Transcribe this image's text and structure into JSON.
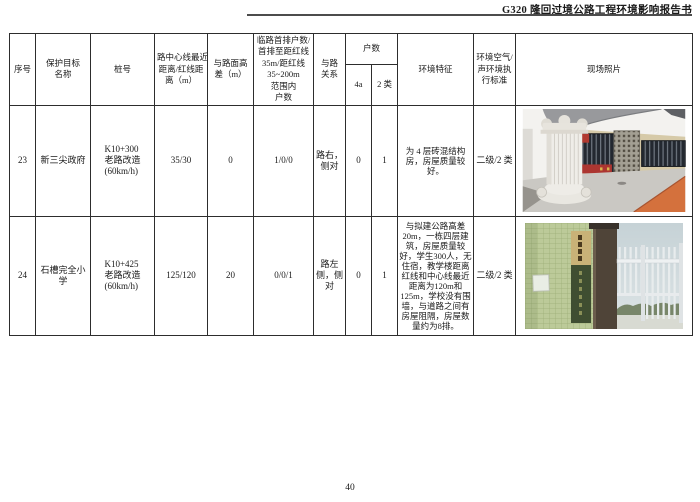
{
  "page": {
    "header_title": "G320 隆回过境公路工程环境影响报告书",
    "page_number": "40"
  },
  "table": {
    "headers": {
      "seq": "序号",
      "target_name": "保护目标\n名称",
      "stake": "桩号",
      "center_dist": "路中心线最近\n距离/红线距\n离（m）",
      "height_diff": "与路面高\n差（m）",
      "front_households": "临路首排户数/\n首排至距红线\n35m/距红线\n35~200m 范围内\n户数",
      "road_relation": "与路\n关系",
      "household_count": "户数",
      "h4a": "4a",
      "h2class": "2 类",
      "env_features": "环境特征",
      "standard": "环境空气/\n声环境执\n行标准",
      "photo": "现场照片"
    },
    "rows": [
      {
        "seq": "23",
        "target_name": "新三尖政府",
        "stake": "K10+300\n老路改造\n(60km/h)",
        "center_dist": "35/30",
        "height_diff": "0",
        "front_households": "1/0/0",
        "road_relation": "路右，侧对",
        "h4a": "0",
        "h2class": "1",
        "env_features": "为 4 层砖混结构房，房屋质量较好。",
        "standard": "二级/2 类"
      },
      {
        "seq": "24",
        "target_name": "石槽完全小学",
        "stake": "K10+425\n老路改造\n(60km/h)",
        "center_dist": "125/120",
        "height_diff": "20",
        "front_households": "0/0/1",
        "road_relation": "路左侧，侧对",
        "h4a": "0",
        "h2class": "1",
        "env_features": "与拟建公路高差20m，一栋四层建筑，房屋质量较好，学生300人，无住宿，教学楼距离红线和中心线最近距离为120m和125m，学校没有围墙，与道路之间有房屋阻隔，房屋数量约为8排。",
        "standard": "二级/2 类"
      }
    ],
    "photos": {
      "row23": "government-office-building-photo",
      "row24": "school-gate-green-wall-photo"
    }
  }
}
